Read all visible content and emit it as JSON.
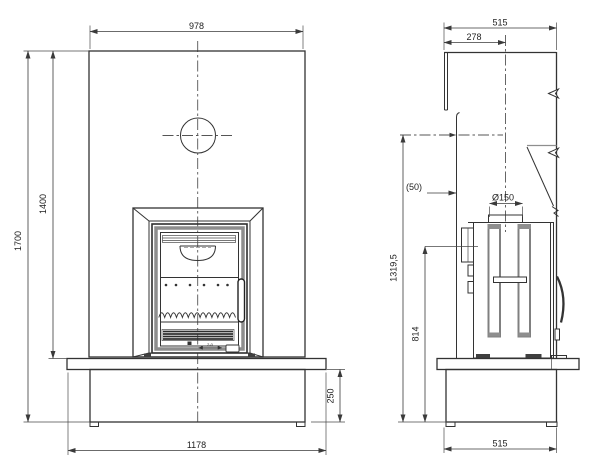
{
  "front": {
    "width_top": "978",
    "height_total": "1700",
    "height_to_bench": "1400",
    "base_height": "250",
    "width_base": "1178",
    "slider_label": "2-0"
  },
  "side": {
    "depth_top": "515",
    "flue_offset": "278",
    "wall_gap": "(50)",
    "flue_diameter": "Ø150",
    "height_level": "1319,5",
    "height_mid": "814",
    "depth_base": "515"
  },
  "colors": {
    "line": "#333333",
    "dimension": "#3a3a3a",
    "accent_gray": "#8e8e8e",
    "background": "#ffffff"
  }
}
